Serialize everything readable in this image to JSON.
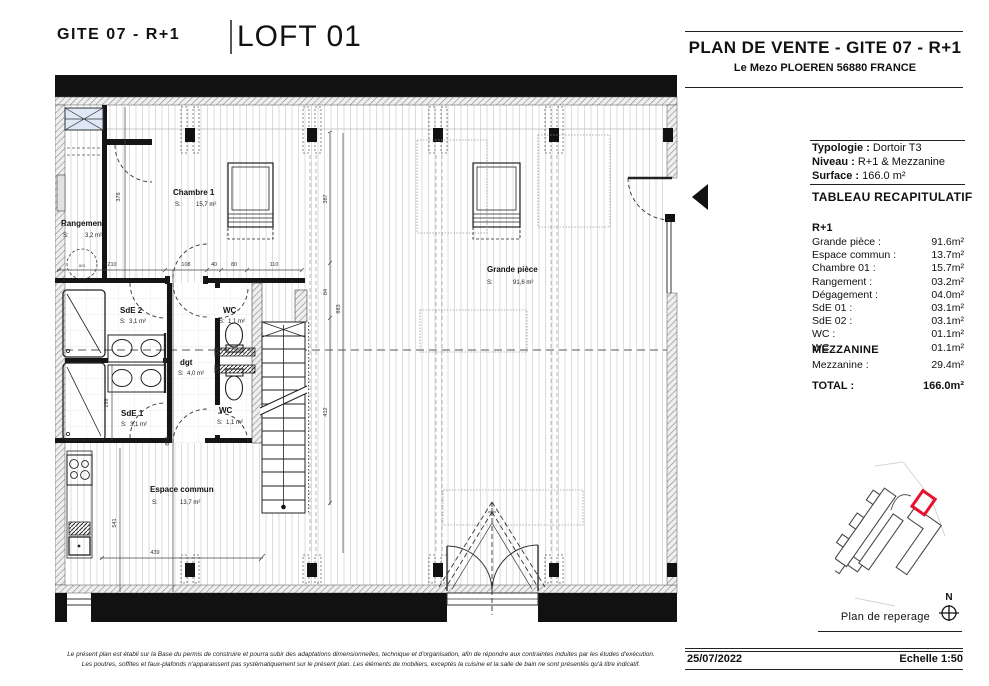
{
  "header": {
    "doc_ref": "GITE 07 - R+1",
    "title": "LOFT 01"
  },
  "panel": {
    "title": "PLAN DE VENTE - GITE 07 - R+1",
    "address": "Le Mezo PLOEREN 56880 FRANCE",
    "info": [
      {
        "label": "Typologie :",
        "value": "Dortoir T3"
      },
      {
        "label": "Niveau :",
        "value": "R+1 & Mezzanine"
      },
      {
        "label": "Surface :",
        "value": "166.0 m²"
      }
    ],
    "table_heading": "TABLEAU RECAPITULATIF",
    "section_r1": {
      "heading": "R+1",
      "rows": [
        {
          "label": "Grande pièce :",
          "value": "91.6m²"
        },
        {
          "label": "Espace commun :",
          "value": "13.7m²"
        },
        {
          "label": "Chambre 01 :",
          "value": "15.7m²"
        },
        {
          "label": "Rangement :",
          "value": "03.2m²"
        },
        {
          "label": "Dégagement :",
          "value": "04.0m²"
        },
        {
          "label": "SdE 01 :",
          "value": "03.1m²"
        },
        {
          "label": "SdE 02 :",
          "value": "03.1m²"
        },
        {
          "label": "WC :",
          "value": "01.1m²"
        },
        {
          "label": "WC :",
          "value": "01.1m²"
        }
      ]
    },
    "section_mezzanine": {
      "heading": "MEZZANINE",
      "rows": [
        {
          "label": "Mezzanine :",
          "value": "29.4m²"
        }
      ]
    },
    "total": {
      "label": "TOTAL :",
      "value": "166.0m²"
    },
    "reperage": {
      "caption": "Plan de reperage",
      "north": "N"
    },
    "footer": {
      "date": "25/07/2022",
      "scale": "Echelle 1:50"
    }
  },
  "plan": {
    "s_prefix": "S:",
    "rooms": [
      {
        "name": "Chambre 1",
        "area": "15,7 m²"
      },
      {
        "name": "Rangement",
        "area": "3,2 m²"
      },
      {
        "name": "SdE 2",
        "area": "3,1 m²"
      },
      {
        "name": "WC",
        "area": "1,1 m²"
      },
      {
        "name": "dgt",
        "area": "4,0 m²"
      },
      {
        "name": "SdE 1",
        "area": "3,1 m²"
      },
      {
        "name": "WC",
        "area": "1,1 m²"
      },
      {
        "name": "Grande pièce",
        "area": "91,6 m²"
      },
      {
        "name": "Espace commun",
        "area": "13,7 m²"
      }
    ],
    "annotations": {
      "hatch": "acs"
    },
    "dimensions": {
      "d378": "378",
      "d210": "210",
      "d108": "108",
      "d40": "40",
      "d80": "80",
      "d110": "110",
      "d387": "387",
      "d84": "84",
      "d883": "883",
      "d412": "412",
      "d199": "199",
      "d679": "679",
      "d541": "541",
      "d439": "439"
    }
  },
  "disclaimer": {
    "line1": "Le présent plan est établi sur la Base du permis de construire et pourra subir des adaptations dimensionnelles, technique et d'organisation, afin de répondre aux contraintes induites par les études d'exécution.",
    "line2": "Les poutres, soffites et faux-plafonds n'apparaissent pas systématiquement sur le présent plan. Les éléments de mobiliers, exceptés la cuisine et la salle de bain ne sont présentés qu'à titre indicatif."
  },
  "colors": {
    "accent_red": "#e8112d",
    "ink": "#111111",
    "window_blue": "#dfe8f6"
  }
}
